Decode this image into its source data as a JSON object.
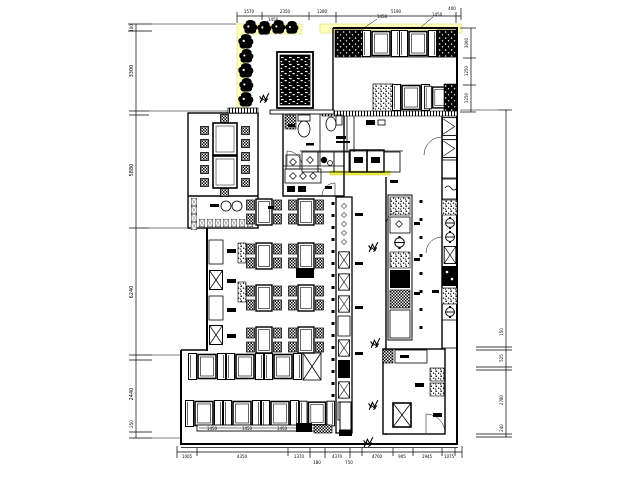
{
  "drawing": {
    "kind": "restaurant-floor-plan-cad",
    "colors": {
      "line": "#000000",
      "highlight_band": "#FFFFBE",
      "highlight_counter": "#F0F046",
      "background": "#FFFFFF"
    },
    "dims": {
      "top": {
        "segments": [
          "1570",
          "2350",
          "1280",
          "5190"
        ],
        "end": "400"
      },
      "left": {
        "segments": [
          "400",
          "3300",
          "5880",
          "6240",
          "2440",
          "250"
        ]
      },
      "right_inner": {
        "segments": [
          "3060",
          "1250",
          "1250"
        ]
      },
      "right_outer": {
        "segments": [
          "150",
          "525",
          "2780",
          "240"
        ]
      },
      "bottom": {
        "segments": [
          "1005",
          "4350",
          "1370",
          "4370",
          "4700",
          "905",
          "1945",
          "1075"
        ],
        "subs": [
          "180",
          "750"
        ]
      },
      "leaders": [
        "1450",
        "1450",
        "1450"
      ],
      "bench_labels": [
        "1450",
        "1450",
        "1450"
      ]
    }
  }
}
